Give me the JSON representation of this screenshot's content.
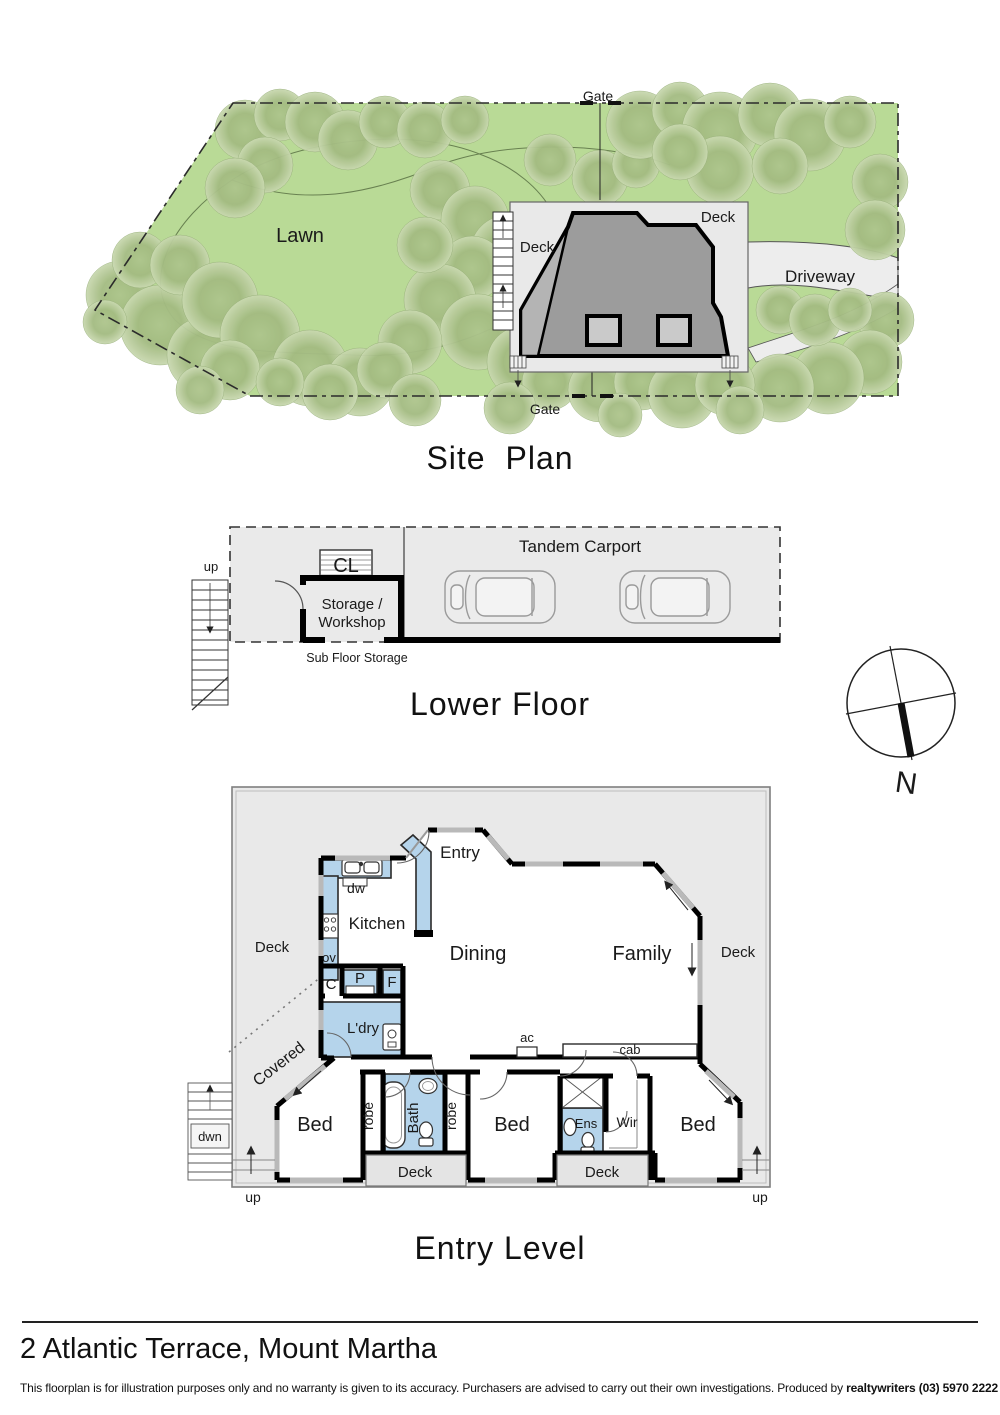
{
  "site_plan": {
    "title": "Site  Plan",
    "labels": {
      "gate_top": "Gate",
      "gate_bottom": "Gate",
      "lawn": "Lawn",
      "deck_left": "Deck",
      "deck_right": "Deck",
      "driveway": "Driveway"
    }
  },
  "lower_floor": {
    "title": "Lower Floor",
    "labels": {
      "up": "up",
      "cl": "CL",
      "storage_line1": "Storage /",
      "storage_line2": "Workshop",
      "carport": "Tandem Carport",
      "subfloor": "Sub Floor Storage"
    }
  },
  "compass": {
    "north": "N"
  },
  "entry_level": {
    "title": "Entry Level",
    "labels": {
      "entry": "Entry",
      "dw": "dw",
      "kitchen": "Kitchen",
      "ov": "ov",
      "c": "C",
      "p": "P",
      "f": "F",
      "ldry": "L'dry",
      "deck_left": "Deck",
      "covered": "Covered",
      "dining": "Dining",
      "family": "Family",
      "deck_right": "Deck",
      "ac": "ac",
      "cab": "cab",
      "bed1": "Bed",
      "robe1": "robe",
      "bath": "Bath",
      "robe2": "robe",
      "bed2": "Bed",
      "ens": "Ens",
      "wir": "Wir",
      "bed3": "Bed",
      "deck_small1": "Deck",
      "deck_small2": "Deck",
      "dwn": "dwn",
      "up_left": "up",
      "up_right": "up"
    }
  },
  "footer": {
    "address": "2 Atlantic Terrace, Mount Martha",
    "disclaimer_text": "This floorplan is for illustration purposes only and no warranty is given to its accuracy. Purchasers are advised to carry out their own investigations. Produced by ",
    "produced_by_bold": "realtywriters (03) 5970 2222"
  },
  "colors": {
    "lawn": "#b9da96",
    "tree": "#a5bd85",
    "plan_gray": "#e9e9e9",
    "house_gray": "#9c9c9c",
    "fixture_blue": "#b5d4eb",
    "wall": "#000000",
    "window_gray": "#b9b9b9",
    "driveway": "#ededed"
  }
}
